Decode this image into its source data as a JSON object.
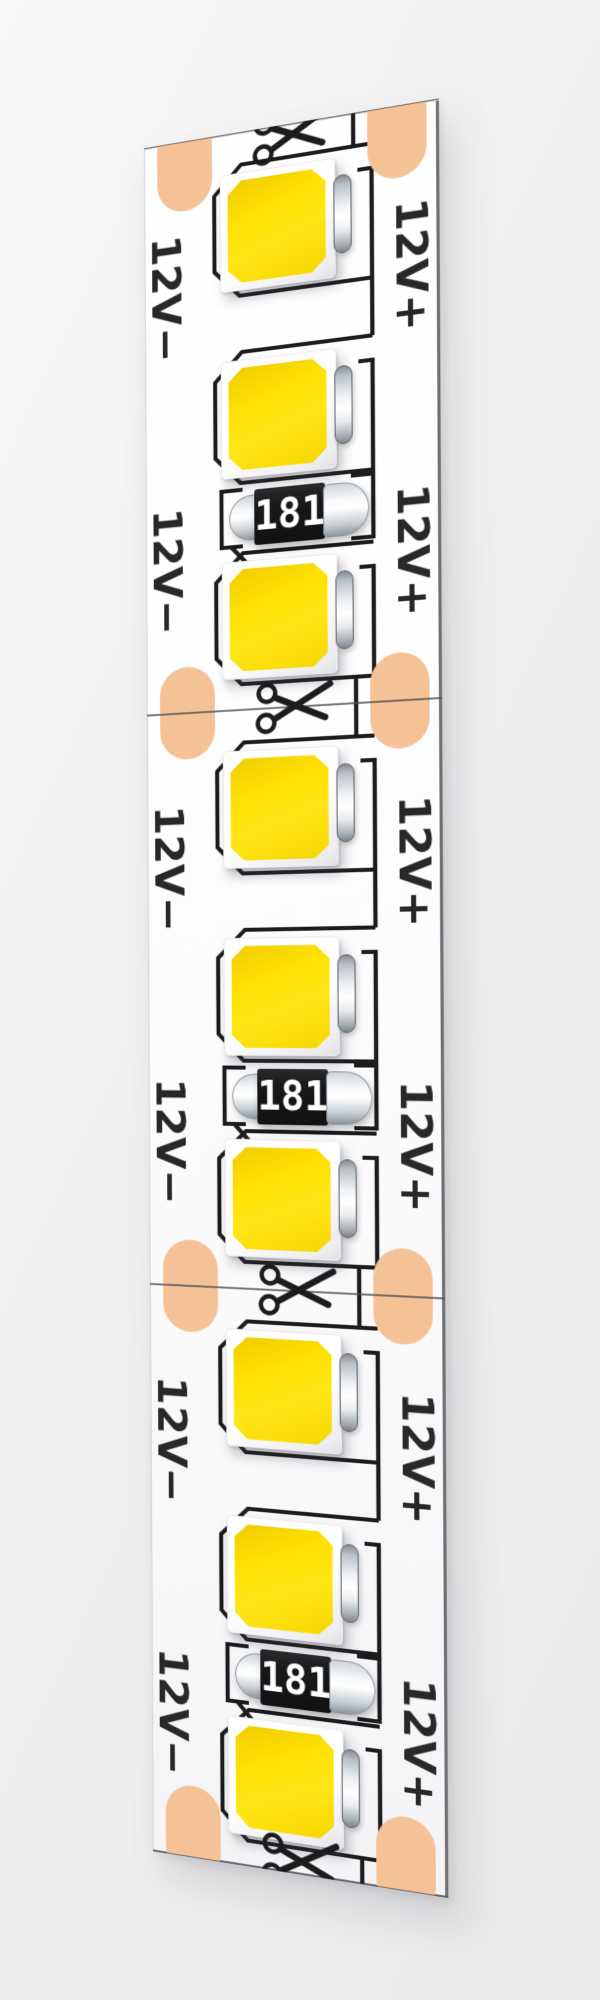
{
  "scene": {
    "description": "3D render of a flexible 12V LED strip, vertical with perspective",
    "background_color": "#f0f0f1",
    "strip_color": "#ffffff"
  },
  "colors": {
    "solder_pad": "#f5c197",
    "trace": "#1c1c1e",
    "cut_line": "#4c4c50",
    "led_yellow": "#ffe203",
    "resistor_body": "#19191b",
    "resistor_text": "#ffffff",
    "label_text": "#28282a"
  },
  "strip": {
    "cut_marks": {
      "count": 4,
      "icon": "scissors-icon"
    },
    "segments": [
      {
        "led_count": 3,
        "resistor_value": "181",
        "labels": [
          {
            "side": "left",
            "text": "12V−"
          },
          {
            "side": "right",
            "text": "12V+"
          },
          {
            "side": "left",
            "text": "12V−"
          },
          {
            "side": "right",
            "text": "12V+"
          }
        ]
      },
      {
        "led_count": 3,
        "resistor_value": "181",
        "labels": [
          {
            "side": "left",
            "text": "12V−"
          },
          {
            "side": "right",
            "text": "12V+"
          },
          {
            "side": "left",
            "text": "12V−"
          },
          {
            "side": "right",
            "text": "12V+"
          }
        ]
      },
      {
        "led_count": 3,
        "resistor_value": "181",
        "labels": [
          {
            "side": "left",
            "text": "12V−"
          },
          {
            "side": "right",
            "text": "12V+"
          },
          {
            "side": "left",
            "text": "12V−"
          },
          {
            "side": "right",
            "text": "12V+"
          }
        ]
      }
    ]
  }
}
